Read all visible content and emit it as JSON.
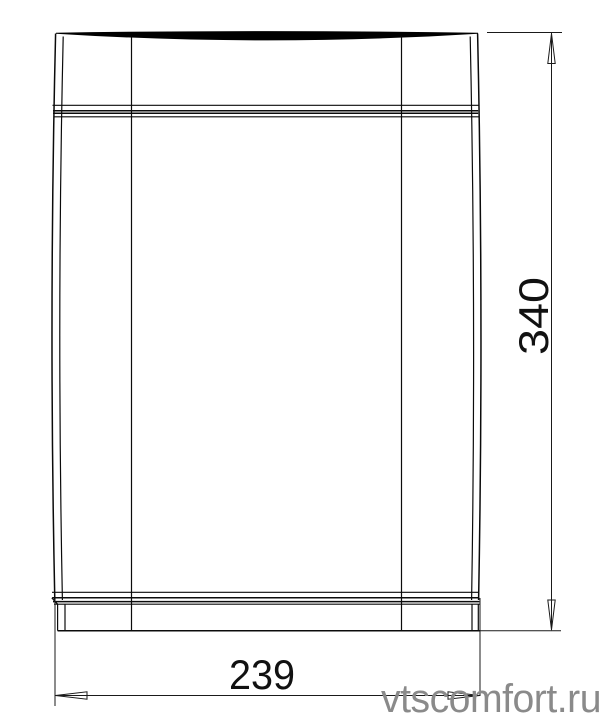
{
  "page": {
    "background_color": "#ffffff",
    "line_color": "#0b0b0b"
  },
  "part_drawing": {
    "view": "front view of rectangular duct section",
    "height_dimension": {
      "value": "340"
    },
    "width_dimension": {
      "value": "239"
    }
  },
  "watermark": {
    "text": "vtscomfort.ru",
    "color": "#8a8a8a"
  }
}
